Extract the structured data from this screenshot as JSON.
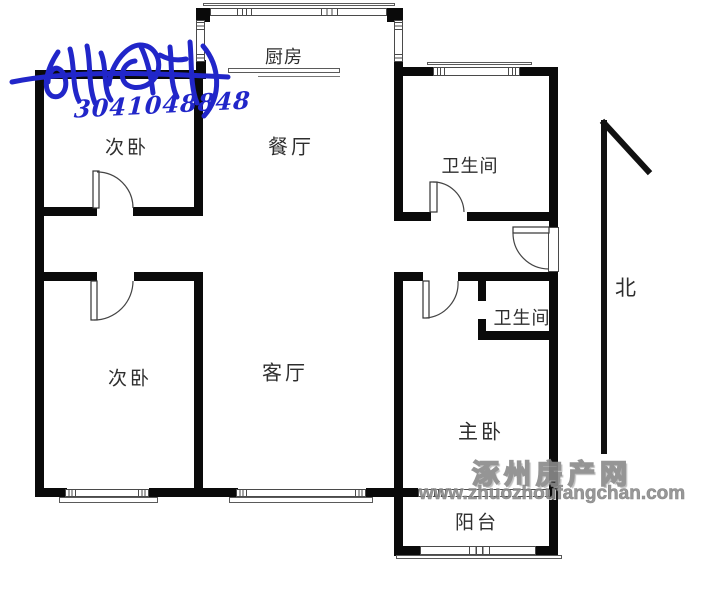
{
  "rooms": {
    "kitchen": "厨房",
    "dining": "餐厅",
    "bedroom_north": "次卧",
    "bathroom_north": "卫生间",
    "bedroom_south": "次卧",
    "living": "客厅",
    "master": "主卧",
    "bathroom_south": "卫生间",
    "balcony": "阳台"
  },
  "compass": {
    "north_label": "北"
  },
  "watermarks": {
    "agent_number": "3041048848",
    "site_name": "涿州房产网",
    "site_url": "www.zhuozhoufangchan.com"
  },
  "colors": {
    "wall": "#0a0a0a",
    "agent_watermark_blue": "#2126c9",
    "site_watermark_gray": "#8d8d8d"
  }
}
